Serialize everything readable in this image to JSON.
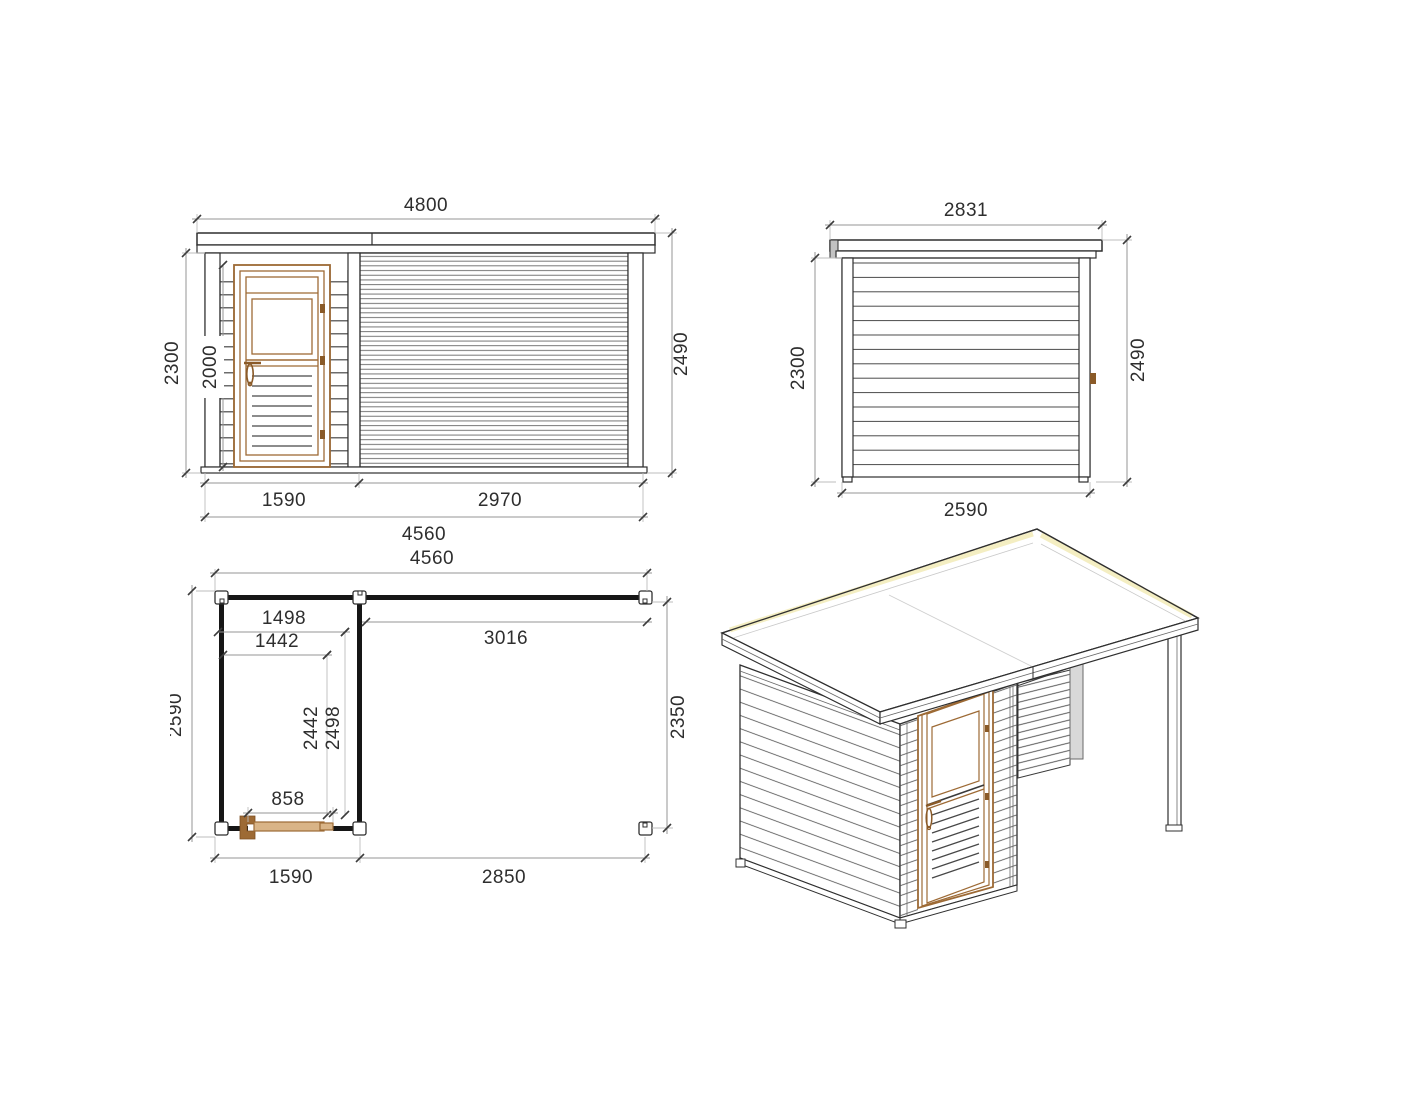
{
  "views": {
    "front_elevation": {
      "dims": {
        "roof_width": "4800",
        "left_height": "2300",
        "door_height": "2000",
        "right_height": "2490",
        "door_section_width": "1590",
        "slat_section_width": "2970",
        "base_width": "4560"
      }
    },
    "side_elevation": {
      "dims": {
        "roof_depth": "2831",
        "left_height": "2300",
        "right_height": "2490",
        "base_depth": "2590"
      }
    },
    "floor_plan": {
      "dims": {
        "total_width": "4560",
        "room_inner_width": "1498",
        "room_glass_width": "1442",
        "canopy_span": "3016",
        "total_depth": "2590",
        "room_depth_inner": "2442",
        "room_depth_outer": "2498",
        "canopy_depth": "2350",
        "door_opening": "858",
        "room_width": "1590",
        "canopy_width": "2850"
      }
    }
  },
  "colors": {
    "line": "#2f2f2f",
    "dim_line": "#949494",
    "tick": "#3c3c3c",
    "text": "#2e2e2e",
    "wood": "#9d6a35",
    "wood_dark": "#8a5a28",
    "wood_fill": "#d9b487",
    "roof_highlight": "#f4eec2",
    "panel_gray": "#d8d8d8",
    "background": "#ffffff"
  }
}
